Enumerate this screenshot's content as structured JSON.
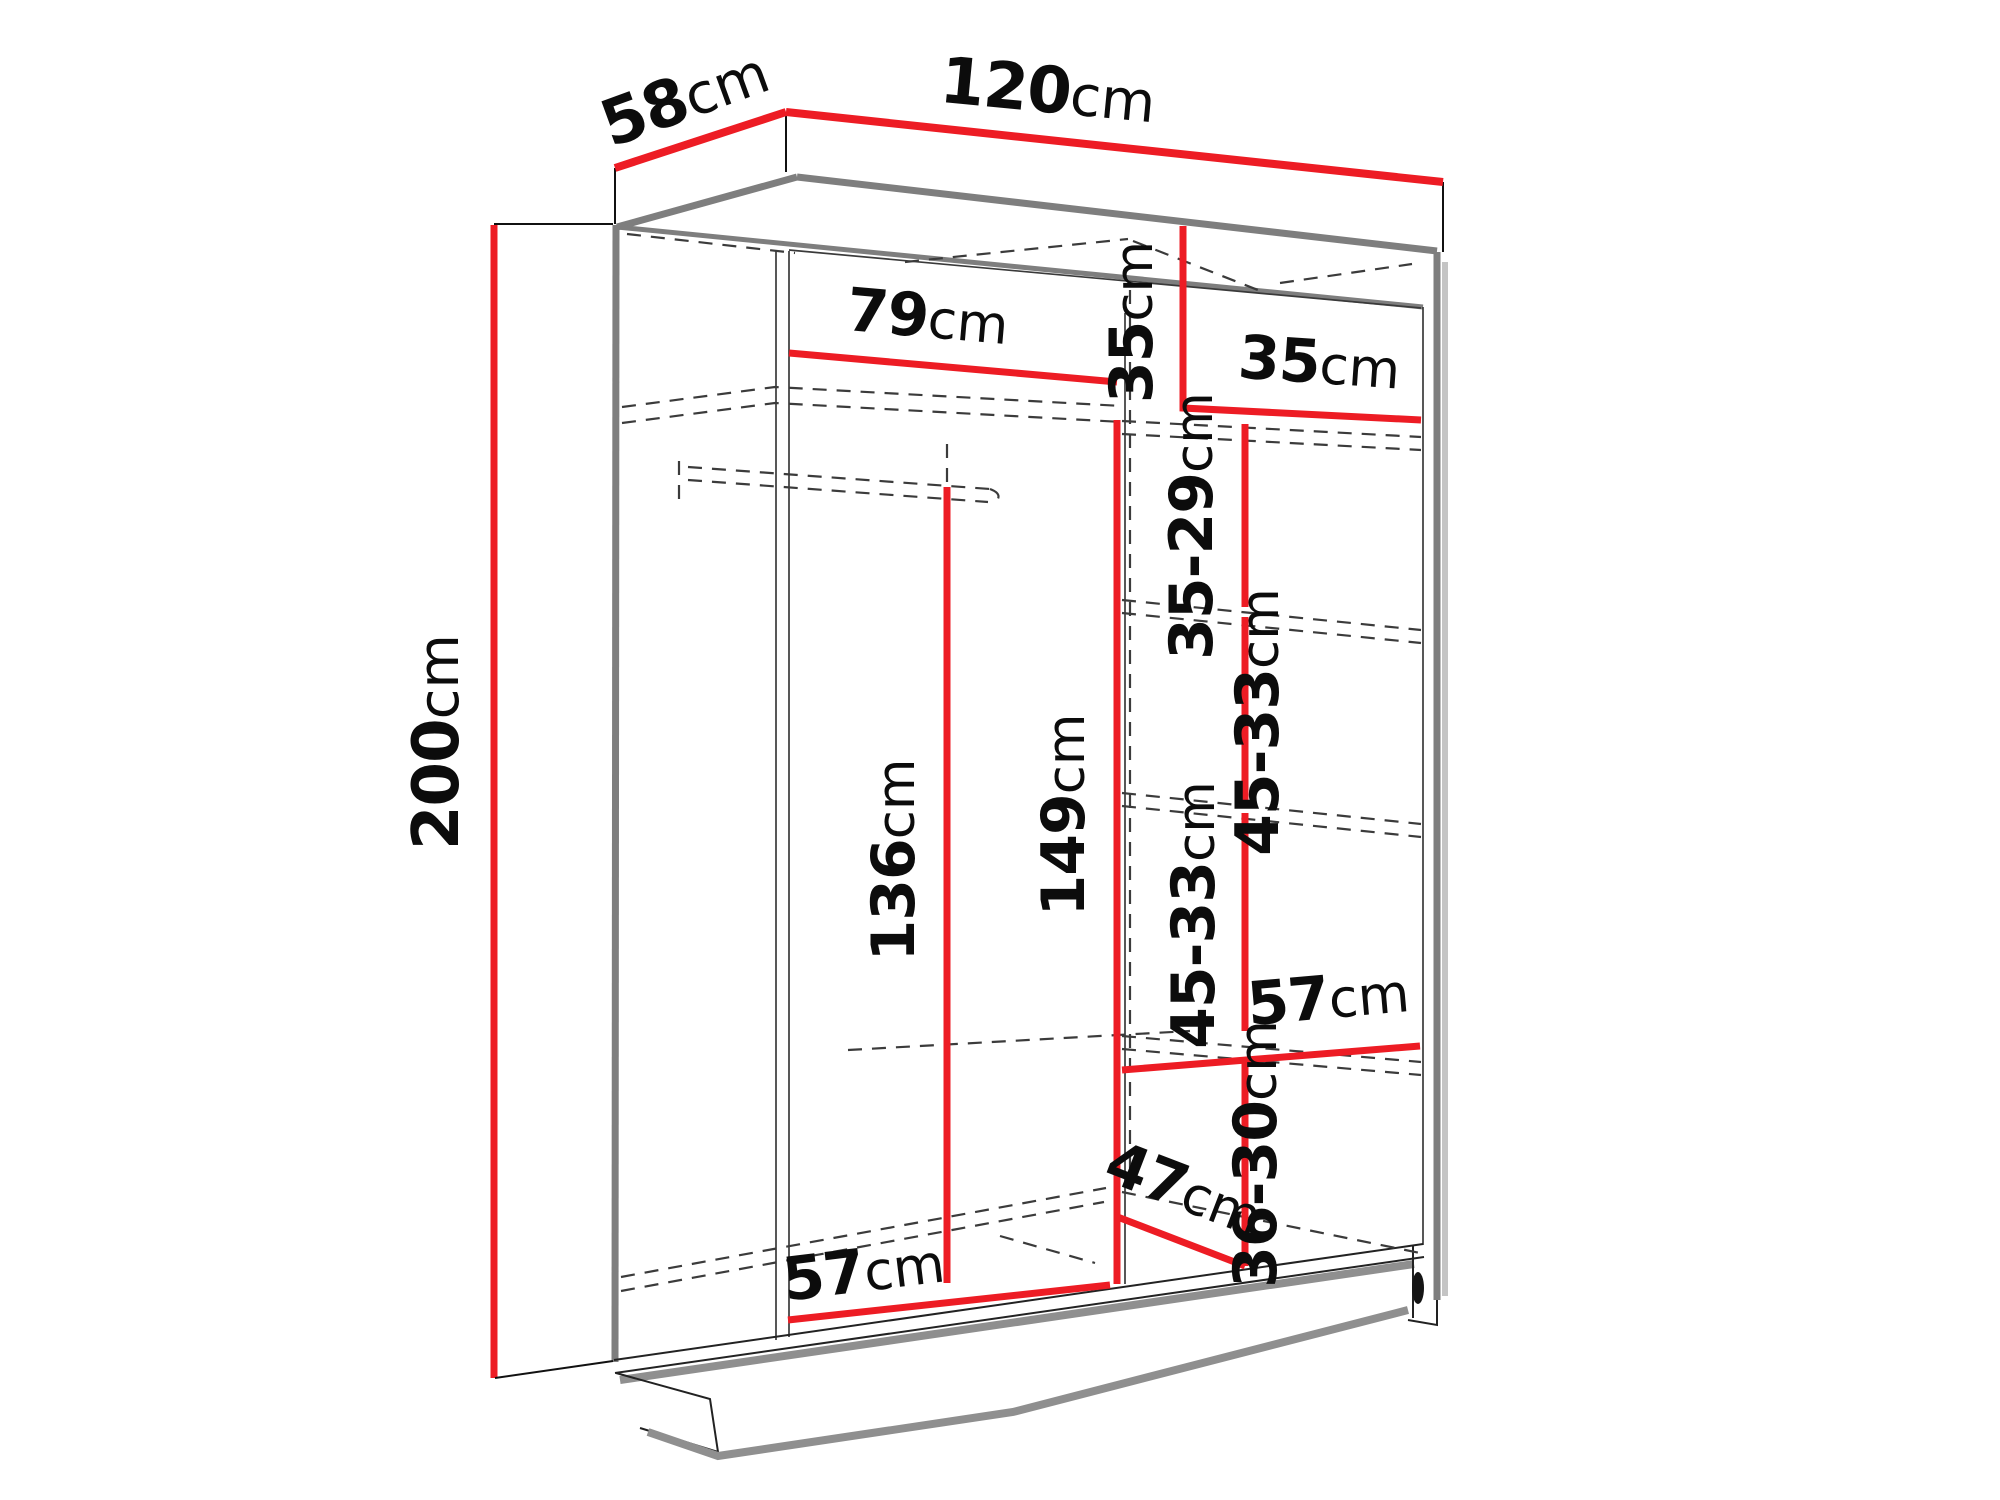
{
  "diagram": {
    "type": "furniture-dimension-diagram",
    "subject": "wardrobe-interior-dimensions",
    "unit": "cm",
    "colors": {
      "dimension_line": "#ed1c24",
      "structure_edge": "#7e7e7e",
      "hidden_line": "#3b3b3b",
      "text": "#0c0c0c",
      "background": "#ffffff"
    },
    "overall": {
      "width": "120",
      "depth": "58",
      "height": "200"
    },
    "dimensions": [
      {
        "value": "58",
        "unit": "cm"
      },
      {
        "value": "120",
        "unit": "cm"
      },
      {
        "value": "200",
        "unit": "cm"
      },
      {
        "value": "79",
        "unit": "cm"
      },
      {
        "value": "35",
        "unit": "cm"
      },
      {
        "value": "35",
        "unit": "cm"
      },
      {
        "value": "35-29",
        "unit": "cm"
      },
      {
        "value": "45-33",
        "unit": "cm"
      },
      {
        "value": "45-33",
        "unit": "cm"
      },
      {
        "value": "36-30",
        "unit": "cm"
      },
      {
        "value": "57",
        "unit": "cm"
      },
      {
        "value": "149",
        "unit": "cm"
      },
      {
        "value": "136",
        "unit": "cm"
      },
      {
        "value": "57",
        "unit": "cm"
      },
      {
        "value": "47",
        "unit": "cm"
      }
    ]
  }
}
